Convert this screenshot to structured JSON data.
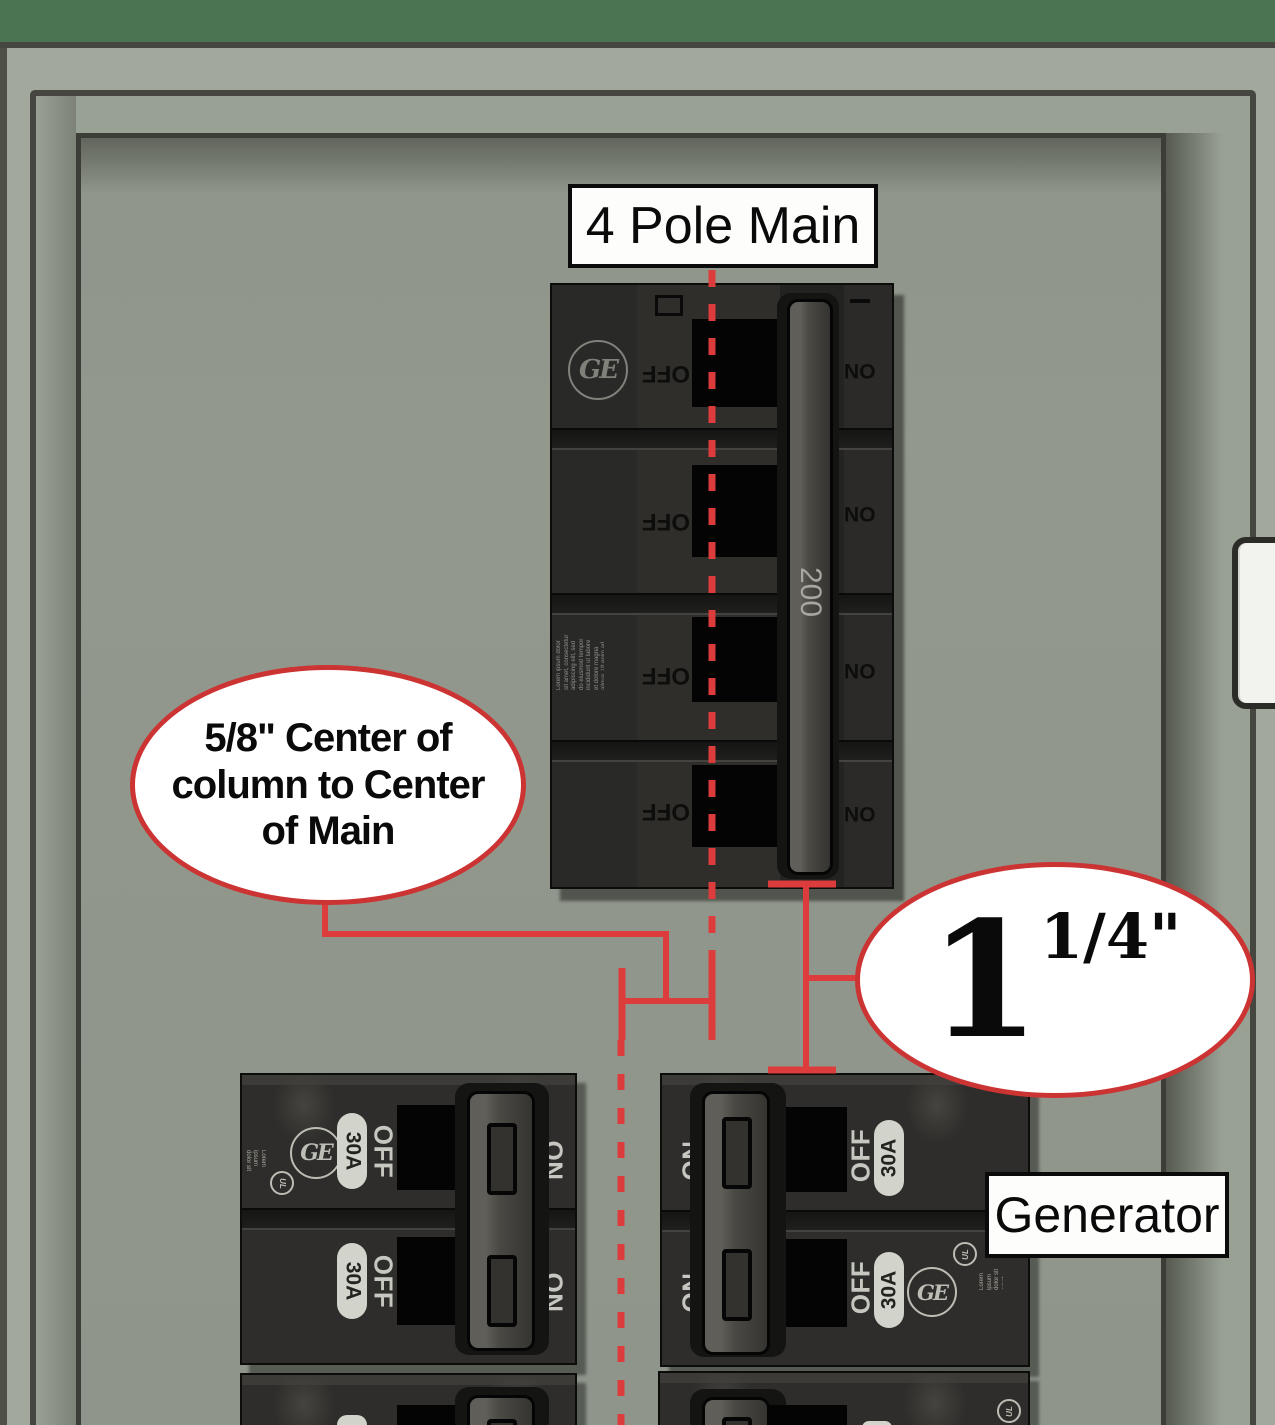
{
  "panel": {
    "top_label": "4 Pole Main",
    "generator_label": "Generator",
    "callout_left": {
      "lines": [
        "5/8\" Center of",
        "column to Center",
        "of Main"
      ],
      "full_text": "5/8\" Center of column to Center of Main"
    },
    "callout_right": {
      "whole": "1",
      "fraction": "1/4\""
    }
  },
  "main_breaker": {
    "brand": "GE",
    "handle_rating": "200",
    "off_label": "OFF",
    "on_label": "ON",
    "fine_print": "Lorem ipsum dolor sit amet, consectetur adipiscing elit, sed do eiusmod tempor incididunt ut labore et dolore magna aliqua. Ut enim ad minim veniam, quis nostrud exercitation ullamco laboris nisi ut aliquip ex ea commodo consequat"
  },
  "generator_breaker_left": {
    "brand": "GE",
    "ul_mark": "UL",
    "rating": "30A",
    "off_label": "OFF",
    "on_label": "ON",
    "fine_print": "Lorem ipsum dolor sit amet consectetur adipiscing elit do eiusmod tempor ut labore et dolor magna aliqua."
  },
  "generator_breaker_right": {
    "brand": "GE",
    "ul_mark": "UL",
    "rating": "30A",
    "off_label": "OFF",
    "on_label": "ON",
    "fine_print": "Lorem ipsum dolor sit amet consectetur adipiscing elit do eiusmod tempor ut labore et dolor magna aliqua."
  },
  "colors": {
    "annotation_red": "#dd3c3c",
    "callout_border_red": "#cc3333",
    "cabinet_green": "#4a7452",
    "panel_gray": "#92988c"
  }
}
